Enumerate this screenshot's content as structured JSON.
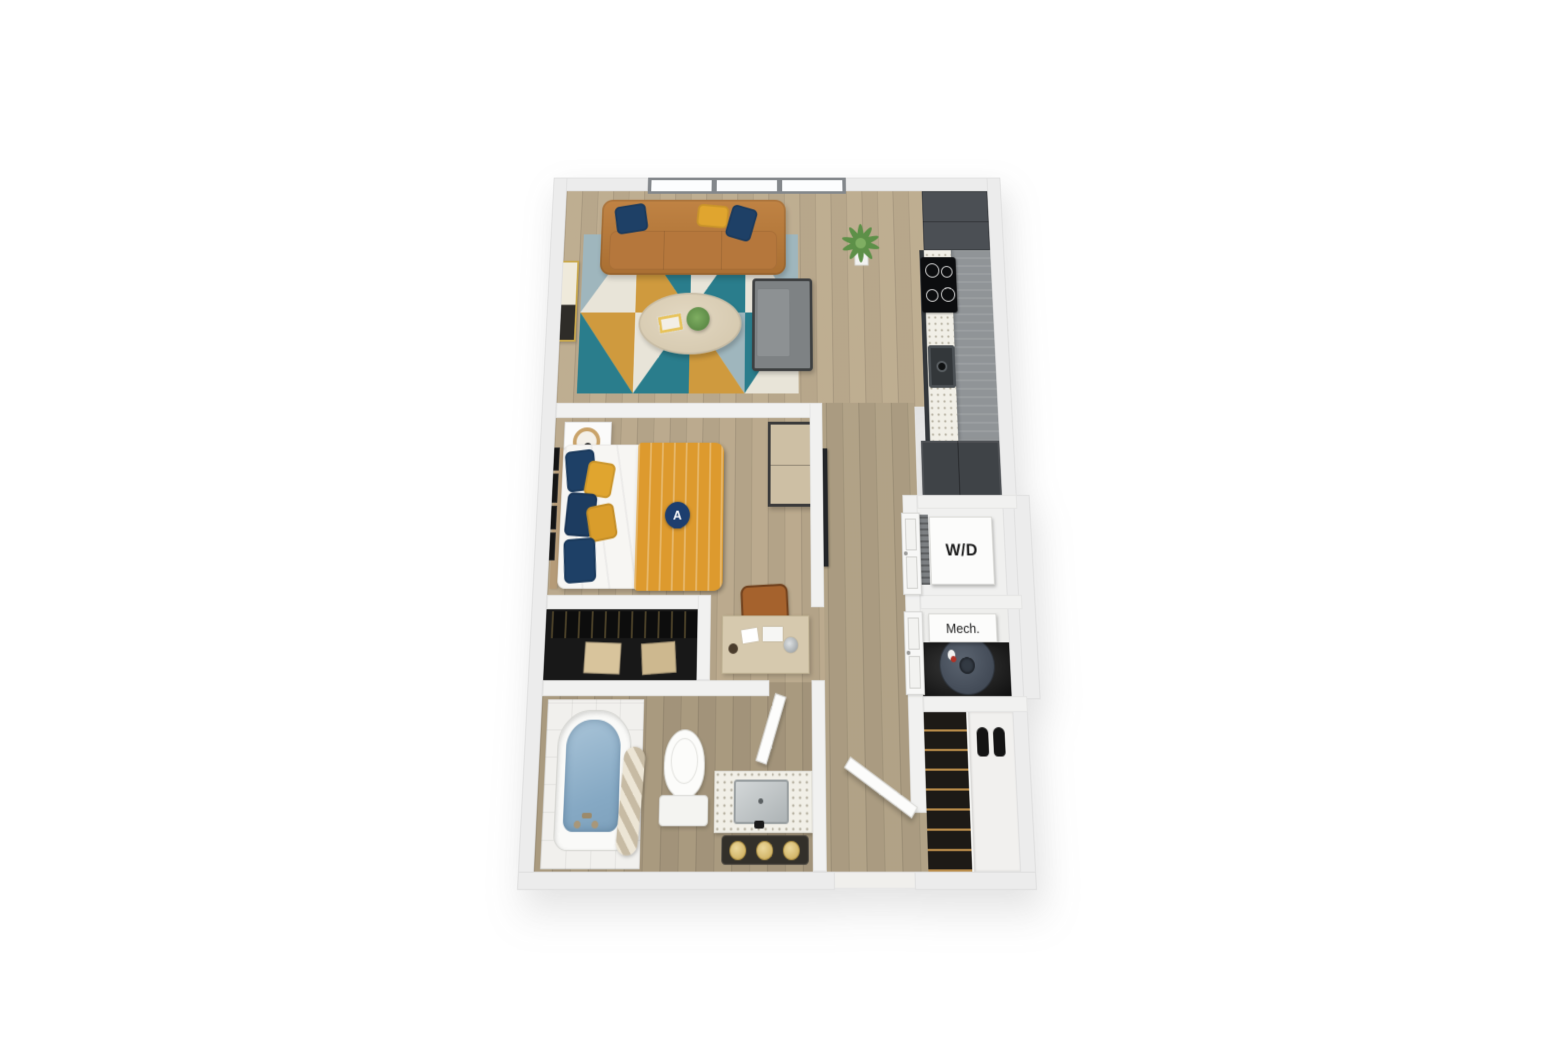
{
  "floorplan": {
    "unit_badge": "A",
    "labels": {
      "washer_dryer": "W/D",
      "mechanical": "Mech."
    },
    "colors": {
      "badge_navy": "#1d3e6e",
      "wall": "#ececec",
      "wood_floor": "#c8b89c",
      "sofa_caramel": "#b5773c",
      "duvet_mustard": "#dd9a2e",
      "pillow_navy": "#1e4066",
      "pillow_mustard": "#e0a52f",
      "rug_teal": "#2a7d8c",
      "rug_steel": "#9fb6bd",
      "rug_mustard": "#cf9a3e",
      "rug_cream": "#e8e4d8",
      "tub_water": "#93b4cd",
      "kitchen_cabinet": "#4b4f54",
      "armchair_gray": "#7e8284",
      "water_heater": "#4a5260"
    }
  }
}
